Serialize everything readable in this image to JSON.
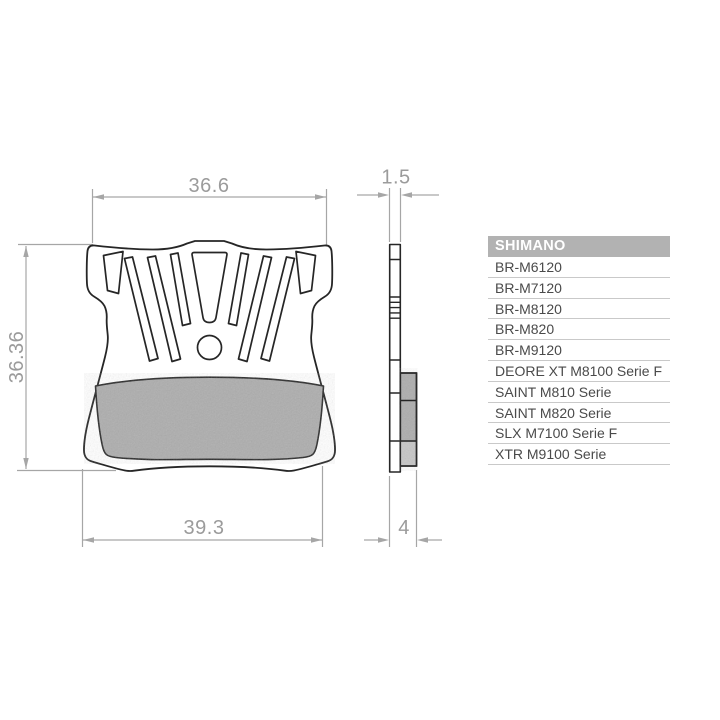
{
  "drawing": {
    "dimensions": {
      "top_width": "36.6",
      "plate_thickness": "1.5",
      "height": "36.36",
      "bottom_width": "39.3",
      "total_thickness": "4"
    },
    "colors": {
      "outline": "#262626",
      "pad_fill": "#adadad",
      "pad_fill_light": "#c6c6c6",
      "dimension_lines": "#a6a6a6",
      "dimension_text": "#9b9b9b"
    }
  },
  "table": {
    "header": "SHIMANO",
    "rows": [
      "BR-M6120",
      "BR-M7120",
      "BR-M8120",
      "BR-M820",
      "BR-M9120",
      "DEORE XT M8100 Serie F",
      "SAINT M810 Serie",
      "SAINT M820 Serie",
      "SLX M7100 Serie F",
      "XTR M9100 Serie"
    ],
    "colors": {
      "header_bg": "#b2b2b2",
      "header_text": "#ffffff",
      "row_text": "#4a4a4a",
      "divider": "#c9c9c9"
    }
  }
}
